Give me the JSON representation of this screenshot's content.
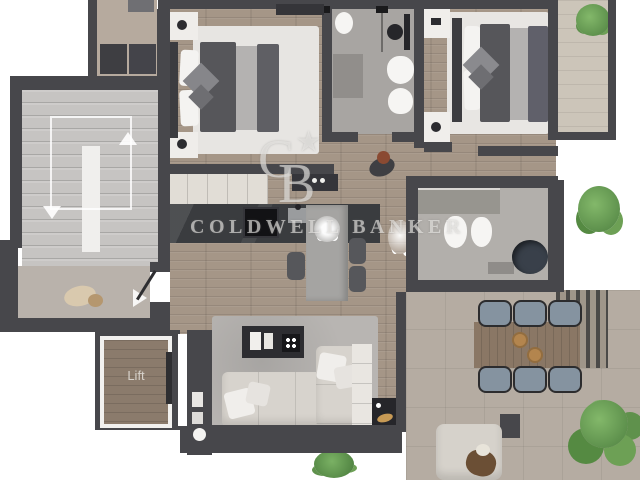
{
  "page": {
    "kind": "real-estate floor plan render",
    "width": 640,
    "height": 480
  },
  "watermark": {
    "brand": "COLDWELL BANKER",
    "monogram": {
      "c": "C",
      "b": "B",
      "star": "★"
    },
    "color": "#eeece9"
  },
  "labels": {
    "lift": "Lift"
  },
  "palette": {
    "wall": "#47474b",
    "wood_floor": "#a59687",
    "stairs": "#c6c4c2",
    "landing": "#b9b2ab",
    "terrace": "#b5aca2",
    "balcony": "#ccc5b9",
    "bath_floor": "#a8a5a2",
    "bedroom_rug": "#e7e5e2",
    "living_rug": "#b8b5b2",
    "sofa": "#d7d3cd",
    "duvet_dark": "#56565a",
    "duvet_light": "#b4b2b1",
    "kitchen_counter": "#3a3c3f",
    "kitchen_island": "#a5a4a2",
    "dining_table": "#8a7765",
    "outdoor_chair": "#8593a0",
    "plant_green": "#5f914c",
    "tub_dark": "#39404a"
  }
}
